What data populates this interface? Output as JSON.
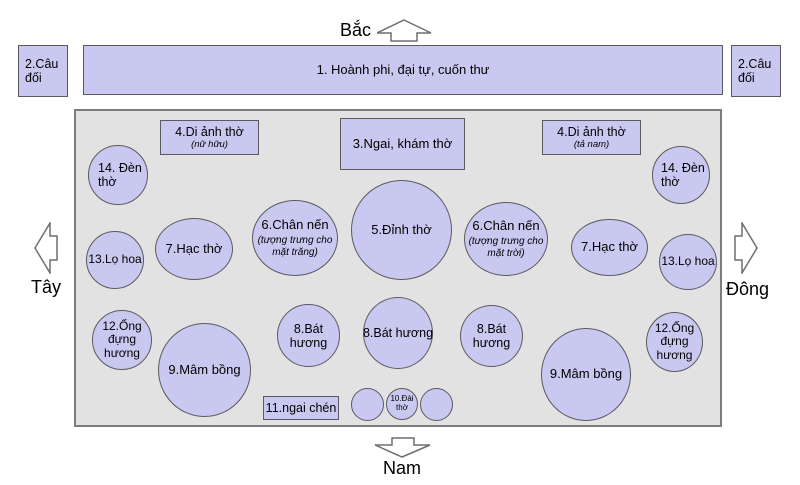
{
  "compass": {
    "north": "Bắc",
    "south": "Nam",
    "west": "Tây",
    "east": "Đông"
  },
  "top_row": {
    "couplet_left": "2.Câu đối",
    "banner": "1. Hoành phi, đại tự, cuốn thư",
    "couplet_right": "2.Câu đối"
  },
  "boxes": {
    "di_anh_left": {
      "title": "4.Di ảnh thờ",
      "subtitle": "(nữ hữu)"
    },
    "ngai_kham": {
      "title": "3.Ngai, khám thờ"
    },
    "di_anh_right": {
      "title": "4.Di ảnh thờ",
      "subtitle": "(tả nam)"
    },
    "ngai_chen": {
      "title": "11.ngai chén"
    }
  },
  "circles": {
    "den_tho_left": "14. Đèn thờ",
    "den_tho_right": "14. Đèn thờ",
    "lo_hoa_left": "13.Lọ hoa",
    "lo_hoa_right": "13.Lọ hoa",
    "hac_tho_left": "7.Hạc thờ",
    "hac_tho_right": "7.Hạc thờ",
    "chan_nen_left": {
      "title": "6.Chân nến",
      "subtitle": "(tượng trưng cho mặt trăng)"
    },
    "chan_nen_right": {
      "title": "6.Chân nến",
      "subtitle": "(tượng trưng cho mặt trời)"
    },
    "dinh_tho": "5.Đỉnh thờ",
    "ong_dung_huong_left": "12.Ống đựng hương",
    "ong_dung_huong_right": "12.Ống đựng hương",
    "mam_bong_left": "9.Mâm bồng",
    "mam_bong_right": "9.Mâm bồng",
    "bat_huong_left": "8.Bát hương",
    "bat_huong_center": "8.Bát hương",
    "bat_huong_right": "8.Bát hương",
    "dai_tho": "10.Đài thờ"
  },
  "colors": {
    "shape_fill": "#c9c8f0",
    "area_fill": "#e3e2e2",
    "shape_border": "#5a5a60"
  }
}
